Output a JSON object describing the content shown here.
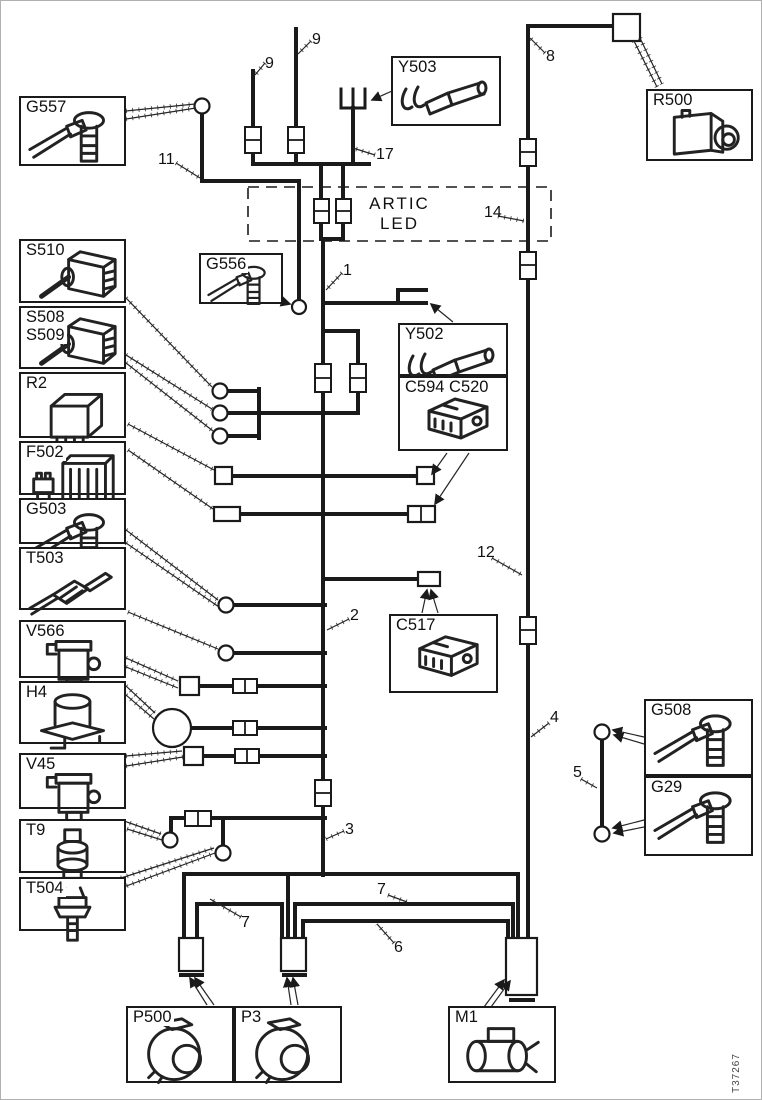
{
  "colors": {
    "line": "#1a1a1a",
    "background": "#ffffff"
  },
  "artic_led": {
    "line1": "ARTIC",
    "line2": "LED"
  },
  "figure_code": "T37267",
  "wire_labels": [
    {
      "text": "9"
    },
    {
      "text": "9"
    },
    {
      "text": "8"
    },
    {
      "text": "11"
    },
    {
      "text": "17"
    },
    {
      "text": "14"
    },
    {
      "text": "1"
    },
    {
      "text": "12"
    },
    {
      "text": "2"
    },
    {
      "text": "4"
    },
    {
      "text": "5"
    },
    {
      "text": "3"
    },
    {
      "text": "7"
    },
    {
      "text": "7"
    },
    {
      "text": "6"
    }
  ],
  "components": [
    {
      "id": "G557",
      "label": "G557",
      "icon": "ground-terminal"
    },
    {
      "id": "S510",
      "label": "S510",
      "icon": "toggle-switch"
    },
    {
      "id": "S508_S509",
      "label": "S508",
      "label2": "S509",
      "icon": "toggle-switch"
    },
    {
      "id": "R2",
      "label": "R2",
      "icon": "relay"
    },
    {
      "id": "F502",
      "label": "F502",
      "icon": "fuse-holder"
    },
    {
      "id": "G503",
      "label": "G503",
      "icon": "ground-terminal"
    },
    {
      "id": "T503",
      "label": "T503",
      "icon": "sensor-probe"
    },
    {
      "id": "V566",
      "label": "V566",
      "icon": "solenoid-valve"
    },
    {
      "id": "H4",
      "label": "H4",
      "icon": "horn"
    },
    {
      "id": "V45",
      "label": "V45",
      "icon": "solenoid-valve"
    },
    {
      "id": "T9",
      "label": "T9",
      "icon": "pressure-sensor"
    },
    {
      "id": "T504",
      "label": "T504",
      "icon": "temperature-sensor"
    },
    {
      "id": "G556",
      "label": "G556",
      "icon": "ground-terminal"
    },
    {
      "id": "Y503",
      "label": "Y503",
      "icon": "cable-terminal"
    },
    {
      "id": "R500",
      "label": "R500",
      "icon": "relay-unit"
    },
    {
      "id": "Y502",
      "label": "Y502",
      "icon": "cable-terminal"
    },
    {
      "id": "C594_C520",
      "label": "C594 C520",
      "icon": "connector-housing"
    },
    {
      "id": "C517",
      "label": "C517",
      "icon": "connector-housing"
    },
    {
      "id": "G508",
      "label": "G508",
      "icon": "ground-terminal"
    },
    {
      "id": "G29",
      "label": "G29",
      "icon": "ground-terminal"
    },
    {
      "id": "P500",
      "label": "P500",
      "icon": "pump-motor"
    },
    {
      "id": "P3",
      "label": "P3",
      "icon": "pump-motor"
    },
    {
      "id": "M1",
      "label": "M1",
      "icon": "starter-motor"
    }
  ]
}
